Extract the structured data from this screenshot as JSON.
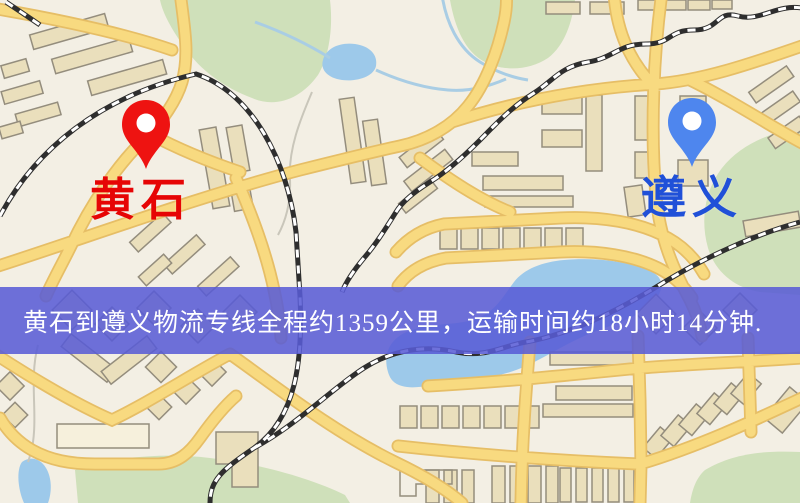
{
  "page": {
    "kind": "logistics-route-map",
    "width": 800,
    "height": 503
  },
  "map": {
    "origin": {
      "label": "黄石"
    },
    "destination": {
      "label": "遵义"
    }
  },
  "banner": {
    "text": "黄石到遵义物流专线全程约1359公里，运输时间约18小时14分钟."
  },
  "route_info": {
    "from": "黄石",
    "to": "遵义",
    "distance_km": "1359",
    "duration": "18小时14分钟"
  },
  "palette": {
    "map-bg": "#f3efe4",
    "road-fill": "#f8da80",
    "road-casing": "#e6be66",
    "building-fill": "#eadfbc",
    "building-stroke": "#948d7d",
    "park": "#cfe0ba",
    "water": "#9dc9ea",
    "stream": "#a9cde4",
    "path-gray": "#c9c6ba",
    "railway-dark": "#2e2e2e",
    "railway-light": "#ffffff",
    "origin-pin": "#ee1311",
    "origin-label": "#e60505",
    "destination-pin": "#4e86ee",
    "destination-label": "#2050d8",
    "banner-bg": "rgba(88,92,214,0.87)",
    "banner-text": "#ffffff"
  }
}
